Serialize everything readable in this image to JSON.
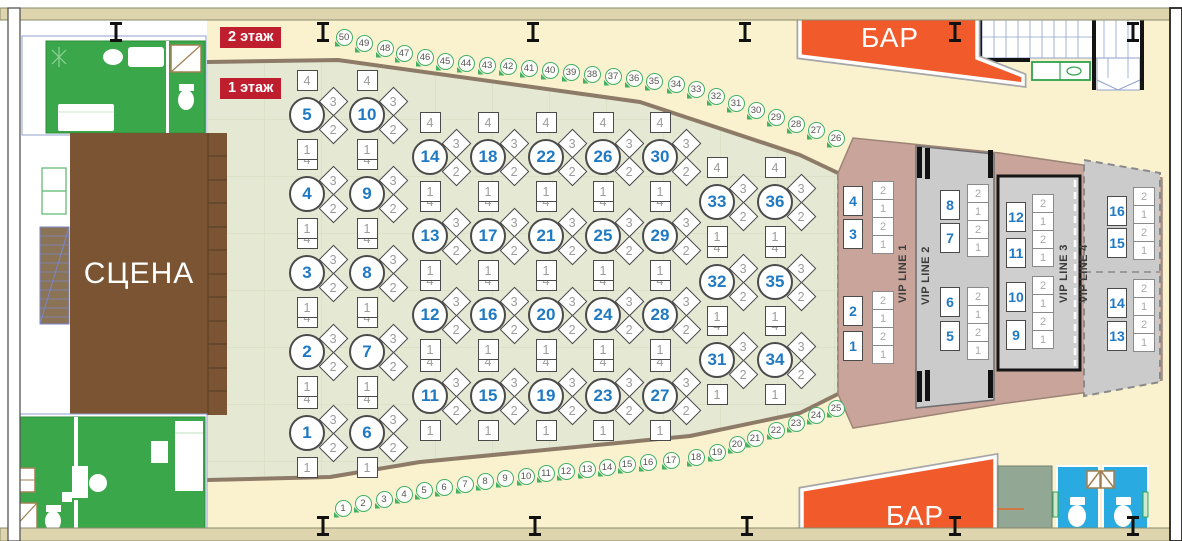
{
  "legend": {
    "floor2": "2 этаж",
    "floor1": "1 этаж"
  },
  "stage": {
    "label": "СЦЕНА"
  },
  "bars": {
    "top": "БАР",
    "bottom": "БАР"
  },
  "vip": {
    "lines": [
      {
        "label": "VIP LINE 1"
      },
      {
        "label": "VIP LINE 2"
      },
      {
        "label": "VIP LINE 3"
      },
      {
        "label": "VIP LINE 4"
      }
    ],
    "seat_labels": [
      "2",
      "1",
      "2",
      "1"
    ],
    "tables": [
      {
        "n": "1",
        "x": 853,
        "y": 346
      },
      {
        "n": "2",
        "x": 853,
        "y": 311
      },
      {
        "n": "3",
        "x": 853,
        "y": 234
      },
      {
        "n": "4",
        "x": 853,
        "y": 201
      },
      {
        "n": "5",
        "x": 950,
        "y": 336
      },
      {
        "n": "6",
        "x": 950,
        "y": 302
      },
      {
        "n": "7",
        "x": 950,
        "y": 238
      },
      {
        "n": "8",
        "x": 950,
        "y": 205
      },
      {
        "n": "9",
        "x": 1016,
        "y": 335
      },
      {
        "n": "10",
        "x": 1016,
        "y": 297
      },
      {
        "n": "11",
        "x": 1016,
        "y": 253
      },
      {
        "n": "12",
        "x": 1016,
        "y": 217
      },
      {
        "n": "13",
        "x": 1117,
        "y": 336
      },
      {
        "n": "14",
        "x": 1117,
        "y": 303
      },
      {
        "n": "15",
        "x": 1117,
        "y": 243
      },
      {
        "n": "16",
        "x": 1117,
        "y": 211
      }
    ],
    "seat_columns": [
      {
        "x": 872,
        "y": 182
      },
      {
        "x": 872,
        "y": 292
      },
      {
        "x": 967,
        "y": 185
      },
      {
        "x": 967,
        "y": 288
      },
      {
        "x": 1032,
        "y": 195
      },
      {
        "x": 1032,
        "y": 277
      },
      {
        "x": 1133,
        "y": 188
      },
      {
        "x": 1133,
        "y": 280
      }
    ]
  },
  "hall": {
    "seat_labels": [
      "4",
      "3",
      "2",
      "1"
    ],
    "tables": [
      {
        "n": "1",
        "x": 307,
        "y": 433
      },
      {
        "n": "2",
        "x": 307,
        "y": 352
      },
      {
        "n": "3",
        "x": 307,
        "y": 273
      },
      {
        "n": "4",
        "x": 307,
        "y": 194
      },
      {
        "n": "5",
        "x": 307,
        "y": 115
      },
      {
        "n": "6",
        "x": 367,
        "y": 433
      },
      {
        "n": "7",
        "x": 367,
        "y": 352
      },
      {
        "n": "8",
        "x": 367,
        "y": 273
      },
      {
        "n": "9",
        "x": 367,
        "y": 194
      },
      {
        "n": "10",
        "x": 367,
        "y": 115
      },
      {
        "n": "11",
        "x": 430,
        "y": 396
      },
      {
        "n": "12",
        "x": 430,
        "y": 315
      },
      {
        "n": "13",
        "x": 430,
        "y": 236
      },
      {
        "n": "14",
        "x": 430,
        "y": 157
      },
      {
        "n": "15",
        "x": 488,
        "y": 396
      },
      {
        "n": "16",
        "x": 488,
        "y": 315
      },
      {
        "n": "17",
        "x": 488,
        "y": 236
      },
      {
        "n": "18",
        "x": 488,
        "y": 157
      },
      {
        "n": "19",
        "x": 546,
        "y": 396
      },
      {
        "n": "20",
        "x": 546,
        "y": 315
      },
      {
        "n": "21",
        "x": 546,
        "y": 236
      },
      {
        "n": "22",
        "x": 546,
        "y": 157
      },
      {
        "n": "23",
        "x": 603,
        "y": 396
      },
      {
        "n": "24",
        "x": 603,
        "y": 315
      },
      {
        "n": "25",
        "x": 603,
        "y": 236
      },
      {
        "n": "26",
        "x": 603,
        "y": 157
      },
      {
        "n": "27",
        "x": 660,
        "y": 396
      },
      {
        "n": "28",
        "x": 660,
        "y": 315
      },
      {
        "n": "29",
        "x": 660,
        "y": 236
      },
      {
        "n": "30",
        "x": 660,
        "y": 157
      },
      {
        "n": "31",
        "x": 717,
        "y": 360
      },
      {
        "n": "32",
        "x": 717,
        "y": 282
      },
      {
        "n": "33",
        "x": 717,
        "y": 202
      },
      {
        "n": "34",
        "x": 775,
        "y": 360
      },
      {
        "n": "35",
        "x": 775,
        "y": 282
      },
      {
        "n": "36",
        "x": 775,
        "y": 202
      }
    ]
  },
  "perimeter_seats": [
    {
      "n": "1",
      "x": 343,
      "y": 508
    },
    {
      "n": "2",
      "x": 363,
      "y": 503
    },
    {
      "n": "3",
      "x": 384,
      "y": 499
    },
    {
      "n": "4",
      "x": 404,
      "y": 494
    },
    {
      "n": "5",
      "x": 424,
      "y": 490
    },
    {
      "n": "6",
      "x": 444,
      "y": 487
    },
    {
      "n": "7",
      "x": 465,
      "y": 484
    },
    {
      "n": "8",
      "x": 485,
      "y": 481
    },
    {
      "n": "9",
      "x": 505,
      "y": 478
    },
    {
      "n": "10",
      "x": 526,
      "y": 476
    },
    {
      "n": "11",
      "x": 546,
      "y": 473
    },
    {
      "n": "12",
      "x": 566,
      "y": 471
    },
    {
      "n": "13",
      "x": 587,
      "y": 469
    },
    {
      "n": "14",
      "x": 607,
      "y": 467
    },
    {
      "n": "15",
      "x": 627,
      "y": 464
    },
    {
      "n": "16",
      "x": 648,
      "y": 462
    },
    {
      "n": "17",
      "x": 671,
      "y": 460
    },
    {
      "n": "18",
      "x": 696,
      "y": 457
    },
    {
      "n": "19",
      "x": 717,
      "y": 452
    },
    {
      "n": "20",
      "x": 737,
      "y": 444
    },
    {
      "n": "21",
      "x": 755,
      "y": 438
    },
    {
      "n": "22",
      "x": 776,
      "y": 430
    },
    {
      "n": "23",
      "x": 796,
      "y": 423
    },
    {
      "n": "24",
      "x": 816,
      "y": 415
    },
    {
      "n": "25",
      "x": 836,
      "y": 408
    },
    {
      "n": "26",
      "x": 836,
      "y": 138
    },
    {
      "n": "27",
      "x": 816,
      "y": 130
    },
    {
      "n": "28",
      "x": 796,
      "y": 124
    },
    {
      "n": "29",
      "x": 776,
      "y": 117
    },
    {
      "n": "30",
      "x": 756,
      "y": 110
    },
    {
      "n": "31",
      "x": 736,
      "y": 103
    },
    {
      "n": "32",
      "x": 716,
      "y": 96
    },
    {
      "n": "33",
      "x": 696,
      "y": 89
    },
    {
      "n": "34",
      "x": 676,
      "y": 84
    },
    {
      "n": "35",
      "x": 654,
      "y": 81
    },
    {
      "n": "36",
      "x": 634,
      "y": 78
    },
    {
      "n": "37",
      "x": 613,
      "y": 76
    },
    {
      "n": "38",
      "x": 592,
      "y": 74
    },
    {
      "n": "39",
      "x": 571,
      "y": 72
    },
    {
      "n": "40",
      "x": 550,
      "y": 70
    },
    {
      "n": "41",
      "x": 529,
      "y": 68
    },
    {
      "n": "42",
      "x": 508,
      "y": 66
    },
    {
      "n": "43",
      "x": 487,
      "y": 65
    },
    {
      "n": "44",
      "x": 466,
      "y": 63
    },
    {
      "n": "45",
      "x": 445,
      "y": 61
    },
    {
      "n": "46",
      "x": 425,
      "y": 57
    },
    {
      "n": "47",
      "x": 404,
      "y": 53
    },
    {
      "n": "48",
      "x": 385,
      "y": 48
    },
    {
      "n": "49",
      "x": 364,
      "y": 43
    },
    {
      "n": "50",
      "x": 344,
      "y": 37
    }
  ],
  "colors": {
    "cream": "#FAF2CF",
    "sage": "#E5E9D4",
    "fan_border": "#8D7B68",
    "stage_brown": "#7B5433",
    "room_green": "#3AA84A",
    "bar_orange": "#F15B2B",
    "badge_red": "#BE1E2D",
    "table_blue": "#2079C3",
    "marker_green": "#43B065",
    "vip_mauve": "#C8A49B",
    "vip_gray": "#CBCBCB",
    "toilet_blue": "#29ABE2",
    "wall_tan": "#DED4AE"
  }
}
